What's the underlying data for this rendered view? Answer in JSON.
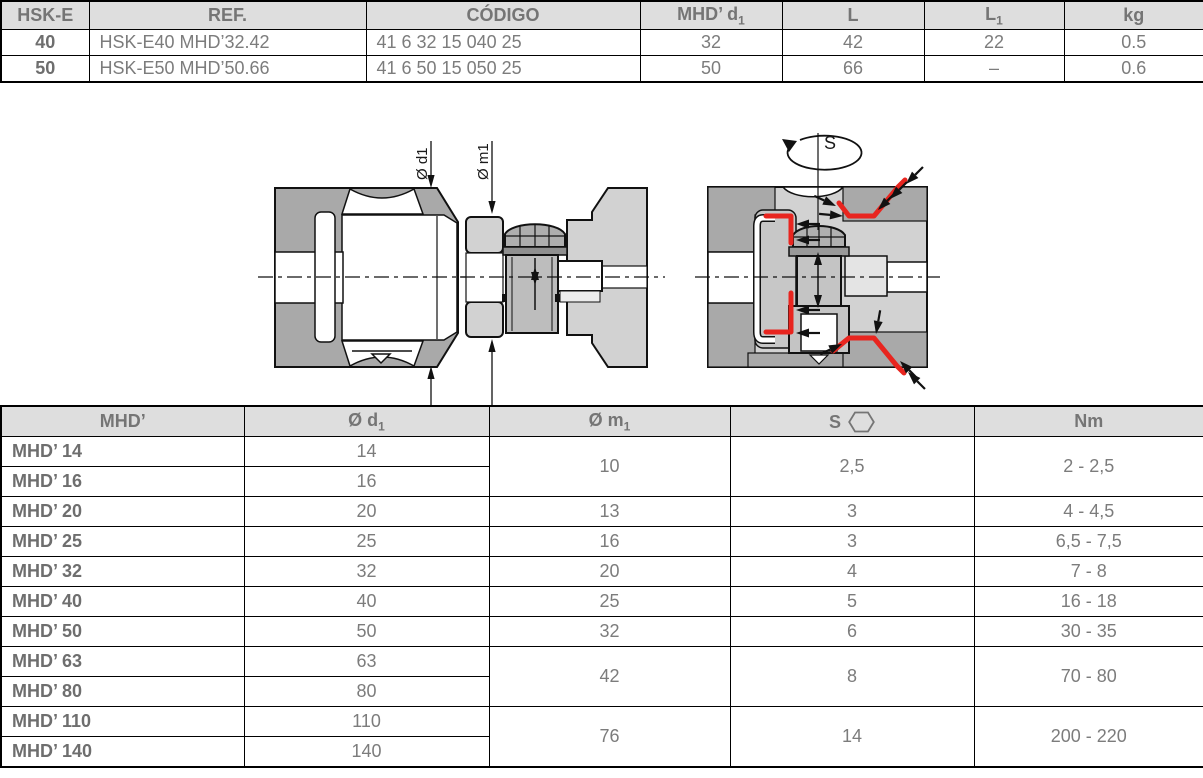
{
  "colors": {
    "highlight_red": "#e8251f",
    "table_header_bg": "#dedede",
    "table_text_gray": "#7c7c7c"
  },
  "diagram": {
    "dim_d1": "Ø d1",
    "dim_m1": "Ø m1",
    "spanner_label": "S"
  },
  "top_table": {
    "col_widths": [
      88,
      277,
      274,
      142,
      142,
      140,
      140
    ],
    "headers": [
      {
        "t": "HSK-E"
      },
      {
        "t": "REF."
      },
      {
        "t": "CÓDIGO"
      },
      {
        "t": "MHD’ d",
        "s": "1"
      },
      {
        "t": "L"
      },
      {
        "t": "L",
        "s": "1"
      },
      {
        "t": "kg"
      }
    ],
    "rows": [
      [
        {
          "t": "40",
          "b": true
        },
        {
          "t": "HSK-E40 MHD’32.42",
          "a": "left"
        },
        {
          "t": "41 6 32 15 040 25",
          "a": "left"
        },
        {
          "t": "32"
        },
        {
          "t": "42"
        },
        {
          "t": "22"
        },
        {
          "t": "0.5"
        }
      ],
      [
        {
          "t": "50",
          "b": true
        },
        {
          "t": "HSK-E50 MHD’50.66",
          "a": "left"
        },
        {
          "t": "41 6 50 15 050 25",
          "a": "left"
        },
        {
          "t": "50"
        },
        {
          "t": "66"
        },
        {
          "t": "–"
        },
        {
          "t": "0.6"
        }
      ]
    ]
  },
  "bottom_table": {
    "col_widths": [
      243,
      245,
      241,
      244,
      230
    ],
    "headers": [
      {
        "t": "MHD’"
      },
      {
        "t": "Ø d",
        "s": "1"
      },
      {
        "t": "Ø m",
        "s": "1"
      },
      {
        "t": "S",
        "icon": "hex"
      },
      {
        "t": "Nm"
      }
    ],
    "rows": [
      [
        {
          "t": "MHD’ 14",
          "b": true,
          "a": "left"
        },
        {
          "t": "14"
        },
        {
          "t": "10",
          "rs": 2
        },
        {
          "t": "2,5",
          "rs": 2
        },
        {
          "t": "2 - 2,5",
          "rs": 2
        }
      ],
      [
        {
          "t": "MHD’ 16",
          "b": true,
          "a": "left"
        },
        {
          "t": "16"
        }
      ],
      [
        {
          "t": "MHD’ 20",
          "b": true,
          "a": "left"
        },
        {
          "t": "20"
        },
        {
          "t": "13"
        },
        {
          "t": "3"
        },
        {
          "t": "4 - 4,5"
        }
      ],
      [
        {
          "t": "MHD’ 25",
          "b": true,
          "a": "left"
        },
        {
          "t": "25"
        },
        {
          "t": "16"
        },
        {
          "t": "3"
        },
        {
          "t": "6,5 - 7,5"
        }
      ],
      [
        {
          "t": "MHD’ 32",
          "b": true,
          "a": "left"
        },
        {
          "t": "32"
        },
        {
          "t": "20"
        },
        {
          "t": "4"
        },
        {
          "t": "7 - 8"
        }
      ],
      [
        {
          "t": "MHD’ 40",
          "b": true,
          "a": "left"
        },
        {
          "t": "40"
        },
        {
          "t": "25"
        },
        {
          "t": "5"
        },
        {
          "t": "16 - 18"
        }
      ],
      [
        {
          "t": "MHD’ 50",
          "b": true,
          "a": "left"
        },
        {
          "t": "50"
        },
        {
          "t": "32"
        },
        {
          "t": "6"
        },
        {
          "t": "30 - 35"
        }
      ],
      [
        {
          "t": "MHD’ 63",
          "b": true,
          "a": "left"
        },
        {
          "t": "63"
        },
        {
          "t": "42",
          "rs": 2
        },
        {
          "t": "8",
          "rs": 2
        },
        {
          "t": "70 - 80",
          "rs": 2
        }
      ],
      [
        {
          "t": "MHD’ 80",
          "b": true,
          "a": "left"
        },
        {
          "t": "80"
        }
      ],
      [
        {
          "t": "MHD’ 110",
          "b": true,
          "a": "left"
        },
        {
          "t": "110"
        },
        {
          "t": "76",
          "rs": 2
        },
        {
          "t": "14",
          "rs": 2
        },
        {
          "t": "200 - 220",
          "rs": 2
        }
      ],
      [
        {
          "t": "MHD’ 140",
          "b": true,
          "a": "left"
        },
        {
          "t": "140"
        }
      ]
    ]
  }
}
